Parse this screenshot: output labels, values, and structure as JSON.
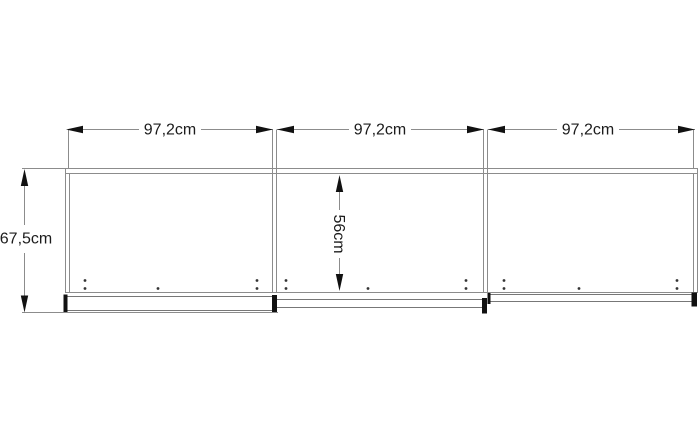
{
  "diagram": {
    "type": "furniture-dimension-drawing",
    "subject": "three-door sliding wardrobe front elevation",
    "section_width_labels": [
      "97,2cm",
      "97,2cm",
      "97,2cm"
    ],
    "total_height_label": "67,5cm",
    "interior_height_label": "56cm",
    "units": "cm",
    "values": {
      "section_widths_cm": [
        97.2,
        97.2,
        97.2
      ],
      "total_height_cm": 67.5,
      "interior_height_cm": 56
    },
    "colors": {
      "background": "#ffffff",
      "body_line": "#8c8c8c",
      "rail_line": "#777777",
      "arrow_and_cap": "#111111",
      "text": "#1c1c1c",
      "hole_dot": "#333333"
    }
  }
}
